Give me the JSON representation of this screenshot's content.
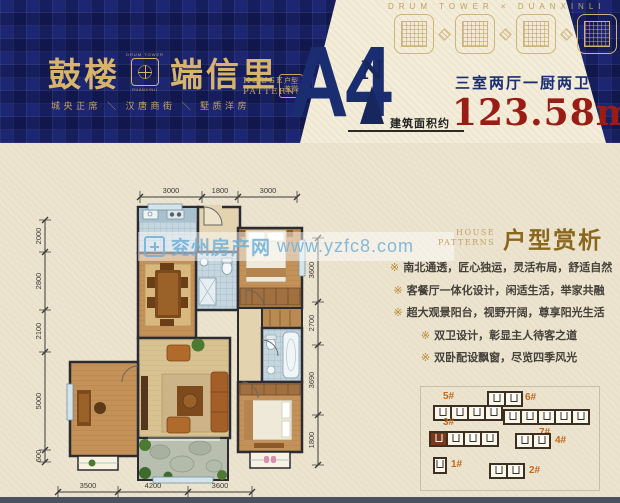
{
  "header": {
    "ribbon": "DRUM TOWER × DUANXINLI",
    "brand": {
      "name_left": "鼓楼",
      "name_right": "端信里",
      "logo_top": "DRUM TOWER",
      "logo_sub": "DUANXINLI",
      "tagline": "城央正席 ＼ 汉唐商街 ＼ 墅质洋房",
      "house_en1": "HOUSE",
      "house_en2": "PATTERNS",
      "seal_l1": "户型",
      "seal_l2": "鉴赏"
    },
    "unit_code": "A4",
    "compass_n": "N",
    "area_label": "建筑面积约",
    "rooms_desc": "三室两厅一厨两卫",
    "area_value": "123.58m",
    "area_sup": "2"
  },
  "watermark": {
    "brand": "兖州房产网",
    "url": "www.yzfc8.com"
  },
  "floorplan": {
    "dims_top": [
      "3000",
      "1800",
      "3000"
    ],
    "dims_left": [
      "2000",
      "2800",
      "2100",
      "5000",
      "600"
    ],
    "dims_right": [
      "3600",
      "2700",
      "3690",
      "1800"
    ],
    "dims_bottom": [
      "3500",
      "4200",
      "3600"
    ]
  },
  "analysis": {
    "en1": "HOUSE",
    "en2": "PATTERNS",
    "cn": "户型赏析",
    "marker": "※",
    "bullets": [
      "南北通透，匠心独运，灵活布局，舒适自然",
      "客餐厅一体化设计，闲适生活，举家共融",
      "超大观景阳台，视野开阔，尊享阳光生活",
      "双卫设计，彰显主人待客之道",
      "双卧配设飘窗，尽览四季风光"
    ]
  },
  "siteplan": {
    "buildings": [
      {
        "label": "5#",
        "units": 4,
        "highlight": -1
      },
      {
        "label": "6#",
        "units": 2,
        "highlight": -1
      },
      {
        "label": "7#",
        "units": 5,
        "highlight": -1
      },
      {
        "label": "3#",
        "units": 4,
        "highlight": 0
      },
      {
        "label": "4#",
        "units": 2,
        "highlight": -1
      },
      {
        "label": "1#",
        "units": 1,
        "highlight": -1
      },
      {
        "label": "2#",
        "units": 2,
        "highlight": -1
      }
    ]
  },
  "colors": {
    "navy": "#1b2d71",
    "gold": "#d7b36c",
    "red": "#9a1d15",
    "orange": "#c2691e"
  }
}
